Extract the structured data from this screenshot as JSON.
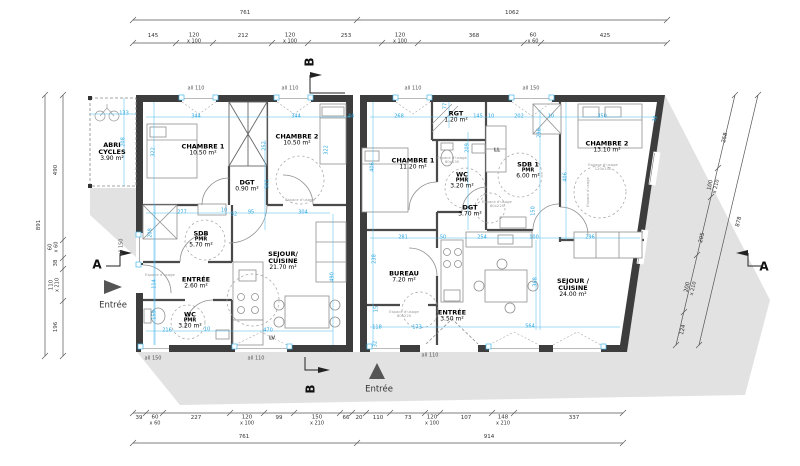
{
  "colors": {
    "dimension_blue": "#2ba7e0",
    "wall": "#3d3d3d",
    "shadow": "#e2e2e2"
  },
  "dims": {
    "top_overall": [
      {
        "v": "761",
        "x": 245,
        "y": 14
      },
      {
        "v": "1062",
        "x": 512,
        "y": 14
      }
    ],
    "top_sub": [
      {
        "v": "145",
        "x": 153,
        "y": 37
      },
      {
        "v": "120",
        "s": "x 100",
        "x": 194,
        "y": 39
      },
      {
        "v": "212",
        "x": 243,
        "y": 37
      },
      {
        "v": "120",
        "s": "x 100",
        "x": 290,
        "y": 39
      },
      {
        "v": "253",
        "x": 346,
        "y": 37
      },
      {
        "v": "120",
        "s": "x 100",
        "x": 400,
        "y": 39
      },
      {
        "v": "368",
        "x": 474,
        "y": 37
      },
      {
        "v": "60",
        "s": "x 60",
        "x": 533,
        "y": 39
      },
      {
        "v": "425",
        "x": 605,
        "y": 37
      }
    ],
    "bottom_sub": [
      {
        "v": "39",
        "x": 139,
        "y": 419
      },
      {
        "v": "60",
        "s": "x 60",
        "x": 155,
        "y": 421
      },
      {
        "v": "227",
        "x": 196,
        "y": 419
      },
      {
        "v": "120",
        "s": "x 100",
        "x": 247,
        "y": 421
      },
      {
        "v": "99",
        "x": 279,
        "y": 419
      },
      {
        "v": "150",
        "s": "x 210",
        "x": 317,
        "y": 421
      },
      {
        "v": "66",
        "x": 346,
        "y": 419
      },
      {
        "v": "20",
        "x": 359,
        "y": 419
      },
      {
        "v": "110",
        "x": 378,
        "y": 419
      },
      {
        "v": "73",
        "x": 408,
        "y": 419
      },
      {
        "v": "120",
        "s": "x 100",
        "x": 432,
        "y": 421
      },
      {
        "v": "107",
        "x": 466,
        "y": 419
      },
      {
        "v": "148",
        "s": "x 210",
        "x": 503,
        "y": 421
      },
      {
        "v": "337",
        "x": 574,
        "y": 419
      }
    ],
    "bottom_overall": [
      {
        "v": "761",
        "x": 244,
        "y": 438
      },
      {
        "v": "914",
        "x": 489,
        "y": 438
      }
    ],
    "left_sub": [
      {
        "v": "490",
        "x": 57,
        "y": 170,
        "rot": -90
      },
      {
        "v": "60",
        "s": "x 60",
        "x": 54,
        "y": 247,
        "rot": -90
      },
      {
        "v": "38",
        "x": 57,
        "y": 263,
        "rot": -90
      },
      {
        "v": "110",
        "s": "x 210",
        "x": 55,
        "y": 285,
        "rot": -90
      },
      {
        "v": "196",
        "x": 57,
        "y": 327,
        "rot": -90
      }
    ],
    "left_overall": [
      {
        "v": "891",
        "x": 40,
        "y": 225,
        "rot": -90
      }
    ],
    "right_sub": [
      {
        "v": "258",
        "x": 726,
        "y": 138,
        "rot": -77
      },
      {
        "v": "100",
        "s": "x 210",
        "x": 714,
        "y": 186,
        "rot": -77
      },
      {
        "v": "205",
        "x": 703,
        "y": 238,
        "rot": -77
      },
      {
        "v": "200",
        "s": "x 210",
        "x": 691,
        "y": 288,
        "rot": -77
      },
      {
        "v": "124",
        "x": 684,
        "y": 330,
        "rot": -77
      }
    ],
    "right_overall": [
      {
        "v": "878",
        "x": 740,
        "y": 222,
        "rot": -77
      }
    ]
  },
  "blue_dims": [
    {
      "v": "133",
      "x": 124,
      "y": 114
    },
    {
      "v": "344",
      "x": 196,
      "y": 117
    },
    {
      "v": "344",
      "x": 296,
      "y": 117
    },
    {
      "v": "44",
      "x": 351,
      "y": 117
    },
    {
      "v": "268",
      "x": 399,
      "y": 117
    },
    {
      "v": "145",
      "x": 478,
      "y": 117
    },
    {
      "v": "10",
      "x": 491,
      "y": 117
    },
    {
      "v": "202",
      "x": 519,
      "y": 117
    },
    {
      "v": "10",
      "x": 551,
      "y": 117
    },
    {
      "v": "350",
      "x": 602,
      "y": 117
    },
    {
      "v": "32",
      "x": 656,
      "y": 119,
      "rot": -77
    },
    {
      "v": "277",
      "x": 182,
      "y": 213
    },
    {
      "v": "10",
      "x": 224,
      "y": 211
    },
    {
      "v": "52",
      "x": 234,
      "y": 215
    },
    {
      "v": "95",
      "x": 251,
      "y": 213
    },
    {
      "v": "304",
      "x": 303,
      "y": 213
    },
    {
      "v": "216",
      "x": 167,
      "y": 331
    },
    {
      "v": "10",
      "x": 207,
      "y": 330
    },
    {
      "v": "470",
      "x": 268,
      "y": 331
    },
    {
      "v": "281",
      "x": 403,
      "y": 238
    },
    {
      "v": "50",
      "x": 443,
      "y": 238
    },
    {
      "v": "254",
      "x": 482,
      "y": 238
    },
    {
      "v": "100",
      "x": 534,
      "y": 238
    },
    {
      "v": "296",
      "x": 590,
      "y": 238
    },
    {
      "v": "118",
      "x": 377,
      "y": 328
    },
    {
      "v": "173",
      "x": 417,
      "y": 328
    },
    {
      "v": "564",
      "x": 530,
      "y": 327
    },
    {
      "v": "208",
      "x": 124,
      "y": 142,
      "rot": -90
    },
    {
      "v": "322",
      "x": 154,
      "y": 152,
      "rot": -90
    },
    {
      "v": "252",
      "x": 265,
      "y": 146,
      "rot": -90
    },
    {
      "v": "322",
      "x": 327,
      "y": 150,
      "rot": -90
    },
    {
      "v": "501",
      "x": 268,
      "y": 184,
      "rot": -90
    },
    {
      "v": "208",
      "x": 151,
      "y": 233,
      "rot": -90
    },
    {
      "v": "114",
      "x": 155,
      "y": 284,
      "rot": -90
    },
    {
      "v": "159",
      "x": 155,
      "y": 315,
      "rot": -90
    },
    {
      "v": "490",
      "x": 333,
      "y": 277,
      "rot": -90
    },
    {
      "v": "77",
      "x": 446,
      "y": 106,
      "rot": -90
    },
    {
      "v": "296",
      "x": 540,
      "y": 133,
      "rot": -90
    },
    {
      "v": "209",
      "x": 468,
      "y": 148,
      "rot": -90
    },
    {
      "v": "406",
      "x": 373,
      "y": 167,
      "rot": -90
    },
    {
      "v": "238",
      "x": 375,
      "y": 259,
      "rot": -90
    },
    {
      "v": "150",
      "x": 534,
      "y": 211,
      "rot": -90
    },
    {
      "v": "368",
      "x": 536,
      "y": 282,
      "rot": -90
    },
    {
      "v": "15",
      "x": 377,
      "y": 309,
      "rot": -90
    },
    {
      "v": "32",
      "x": 376,
      "y": 344,
      "rot": -90
    },
    {
      "v": "406",
      "x": 566,
      "y": 177,
      "rot": -90
    }
  ],
  "wall_labels": [
    {
      "v": "all 110",
      "x": 196,
      "y": 89
    },
    {
      "v": "all 110",
      "x": 290,
      "y": 89
    },
    {
      "v": "all 110",
      "x": 413,
      "y": 89
    },
    {
      "v": "all 150",
      "x": 531,
      "y": 89
    },
    {
      "v": "all 150",
      "x": 122,
      "y": 247,
      "rot": -90
    },
    {
      "v": "all 150",
      "x": 153,
      "y": 359
    },
    {
      "v": "all 110",
      "x": 256,
      "y": 359
    },
    {
      "v": "all 110",
      "x": 430,
      "y": 356
    }
  ],
  "rooms": [
    {
      "name": "ABRI",
      "name2": "CYCLES",
      "area": "3.90 m²",
      "x": 112,
      "y": 152
    },
    {
      "name": "CHAMBRE 1",
      "area": "10.50 m²",
      "x": 203,
      "y": 150
    },
    {
      "name": "CHAMBRE 2",
      "area": "10.50 m²",
      "x": 297,
      "y": 140
    },
    {
      "name": "DGT",
      "area": "0.90 m²",
      "x": 247,
      "y": 186
    },
    {
      "name": "SDB",
      "sub": "PMR",
      "area": "5.70 m²",
      "x": 201,
      "y": 240
    },
    {
      "name": "ENTRÉE",
      "area": "2.60 m²",
      "x": 196,
      "y": 283
    },
    {
      "name": "WC",
      "sub": "PMR",
      "area": "3.20 m²",
      "x": 190,
      "y": 321
    },
    {
      "name": "SEJOUR/",
      "name2": "CUISINE",
      "area": "21.70 m²",
      "x": 283,
      "y": 261
    },
    {
      "name": "RGT",
      "area": "1.20 m²",
      "x": 456,
      "y": 117
    },
    {
      "name": "CHAMBRE 1",
      "area": "11.20 m²",
      "x": 413,
      "y": 164
    },
    {
      "name": "WC",
      "sub": "PMR",
      "area": "3.20 m²",
      "x": 462,
      "y": 181
    },
    {
      "name": "SDB 1",
      "sub": "PMR",
      "area": "6.00 m²",
      "x": 528,
      "y": 171
    },
    {
      "name": "CHAMBRE 2",
      "area": "13.10 m²",
      "x": 607,
      "y": 147
    },
    {
      "name": "DGT",
      "area": "3.70 m²",
      "x": 470,
      "y": 211
    },
    {
      "name": "BUREAU",
      "area": "7.20 m²",
      "x": 404,
      "y": 277
    },
    {
      "name": "ENTRÉE",
      "area": "3.50 m²",
      "x": 452,
      "y": 316
    },
    {
      "name": "SEJOUR /",
      "name2": "CUISINE",
      "area": "24.00 m²",
      "x": 573,
      "y": 288
    }
  ],
  "notes": [
    {
      "t": "Espace d'usage",
      "x": 160,
      "y": 275
    },
    {
      "t": "Espace d'usage",
      "x": 300,
      "y": 200
    },
    {
      "t": "Espace d'usage",
      "d": "80x130",
      "x": 452,
      "y": 160
    },
    {
      "t": "Espace d'usage",
      "d": "80x220",
      "x": 497,
      "y": 204
    },
    {
      "t": "Espace d'usage",
      "d": "80x220",
      "x": 404,
      "y": 314
    },
    {
      "t": "Espace d'usage",
      "d": "120x140",
      "x": 603,
      "y": 167
    },
    {
      "t": "Espace d'usage",
      "x": 588,
      "y": 192,
      "rot": -90
    }
  ],
  "appliances": [
    {
      "v": "LL",
      "x": 497,
      "y": 151
    },
    {
      "v": "LV",
      "x": 272,
      "y": 339
    }
  ],
  "markers": [
    {
      "v": "A",
      "x": 97,
      "y": 265
    },
    {
      "v": "A",
      "x": 764,
      "y": 267
    },
    {
      "v": "B",
      "x": 310,
      "y": 62,
      "rot": -90
    },
    {
      "v": "B",
      "x": 311,
      "y": 389,
      "rot": -90
    }
  ],
  "entrances": [
    {
      "v": "Entrée",
      "x": 113,
      "y": 306
    },
    {
      "v": "Entrée",
      "x": 379,
      "y": 390
    }
  ]
}
